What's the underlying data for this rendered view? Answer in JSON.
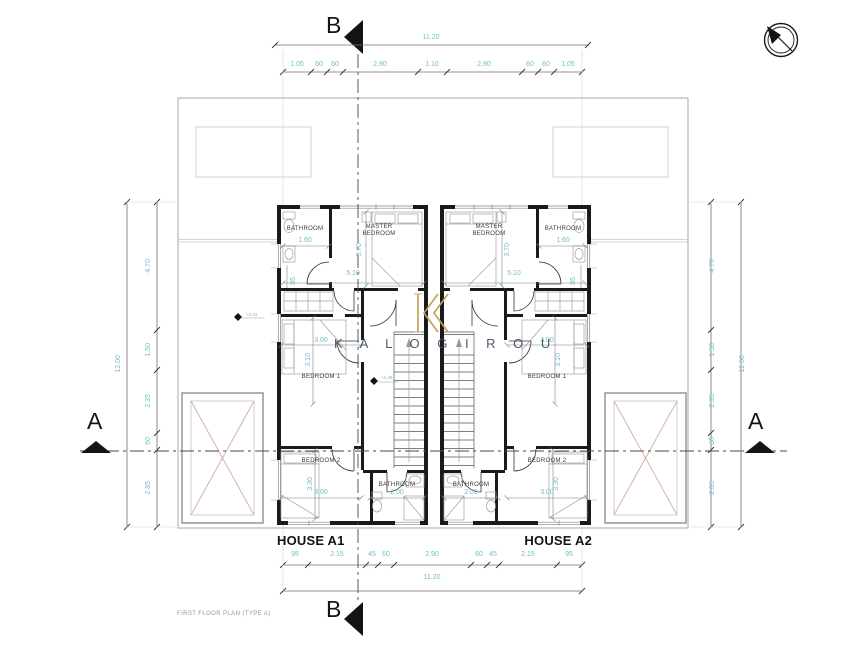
{
  "drawing": {
    "title": "FIRST FLOOR PLAN (TYPE A)"
  },
  "brand": {
    "name": "K A L O G I R O U"
  },
  "sections": {
    "a": "A",
    "b": "B"
  },
  "houses": {
    "left": "HOUSE A1",
    "right": "HOUSE A2"
  },
  "rooms": {
    "bathroom": "BATHROOM",
    "master1": "MASTER",
    "master2": "BEDROOM",
    "bedroom1": "BEDROOM 1",
    "bedroom2": "BEDROOM 2"
  },
  "dims": {
    "total_w": "11.20",
    "total_h": "12.00",
    "top": [
      "1.05",
      "60",
      "60",
      "2.80",
      "1.10",
      "2.80",
      "60",
      "60",
      "1.05"
    ],
    "bottom": [
      "95",
      "2.15",
      "45",
      "60",
      "2.90",
      "60",
      "45",
      "2.15",
      "95"
    ],
    "side": [
      "4.70",
      "1.50",
      "2.35",
      "60",
      "2.85"
    ],
    "interior": {
      "bath_top": "1.60",
      "master_d": "3.70",
      "band_w": "5.10",
      "wall": "85",
      "bed1_w": "3.00",
      "bed1_d": "3.10",
      "bed2_d": "3.30",
      "bed2_w": "3.00",
      "bath_b": "2.00"
    }
  },
  "levels": {
    "floor": "+2.43",
    "stair": "+1.46"
  },
  "colors": {
    "dim_text": "#6fbfca",
    "walls": "#1a1a1a",
    "brand_gold": "#c6a15b",
    "brand_blue": "#3f4e63"
  }
}
